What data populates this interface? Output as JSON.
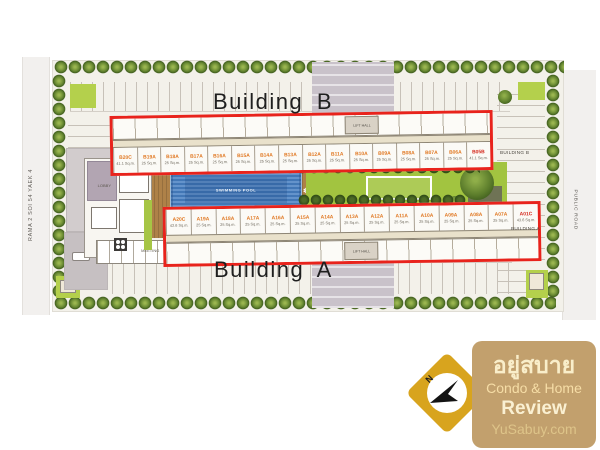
{
  "plan": {
    "title_building_b": "Building B",
    "title_building_a": "Building A",
    "side_label_building_b": "BUILDING B",
    "side_label_building_a": "BUILDING A",
    "road_left": "RAMA 2  SOI 54 YAEK 4",
    "road_right": "PUBLIC ROAD",
    "swimming_pool_label": "SWIMMING POOL",
    "lobby_label": "LOBBY",
    "meeting_label": "MEETING",
    "lift_hall_label": "LIFT HALL",
    "building_b_units": [
      {
        "id": "B20C",
        "area": "41.1 Sq.m."
      },
      {
        "id": "B19A",
        "area": "25 Sq.m."
      },
      {
        "id": "B18A",
        "area": "25 Sq.m."
      },
      {
        "id": "B17A",
        "area": "25 Sq.m."
      },
      {
        "id": "B16A",
        "area": "25 Sq.m."
      },
      {
        "id": "B15A",
        "area": "25 Sq.m."
      },
      {
        "id": "B14A",
        "area": "25 Sq.m."
      },
      {
        "id": "B13A",
        "area": "25 Sq.m."
      },
      {
        "id": "B12A",
        "area": "25 Sq.m."
      },
      {
        "id": "B11A",
        "area": "25 Sq.m."
      },
      {
        "id": "B10A",
        "area": "25 Sq.m."
      },
      {
        "id": "B09A",
        "area": "25 Sq.m."
      },
      {
        "id": "B08A",
        "area": "25 Sq.m."
      },
      {
        "id": "B07A",
        "area": "25 Sq.m."
      },
      {
        "id": "B06A",
        "area": "25 Sq.m."
      },
      {
        "id": "B05B",
        "area": "41.1 Sq.m.",
        "cls": "red"
      }
    ],
    "building_a_units": [
      {
        "id": "A20C",
        "area": "43.6 Sq.m."
      },
      {
        "id": "A19A",
        "area": "25 Sq.m."
      },
      {
        "id": "A18A",
        "area": "25 Sq.m."
      },
      {
        "id": "A17A",
        "area": "25 Sq.m."
      },
      {
        "id": "A16A",
        "area": "25 Sq.m."
      },
      {
        "id": "A15A",
        "area": "25 Sq.m."
      },
      {
        "id": "A14A",
        "area": "25 Sq.m."
      },
      {
        "id": "A13A",
        "area": "25 Sq.m."
      },
      {
        "id": "A12A",
        "area": "25 Sq.m."
      },
      {
        "id": "A11A",
        "area": "25 Sq.m."
      },
      {
        "id": "A10A",
        "area": "25 Sq.m."
      },
      {
        "id": "A09A",
        "area": "25 Sq.m."
      },
      {
        "id": "A08A",
        "area": "25 Sq.m."
      },
      {
        "id": "A07A",
        "area": "25 Sq.m."
      },
      {
        "id": "A01C",
        "area": "43.6 Sq.m.",
        "cls": "red"
      }
    ],
    "colors": {
      "building_outline_red": "#e8231c",
      "unit_label_orange": "#e0761f",
      "unit_label_red": "#d4281c",
      "pool_blue": "#4277b6",
      "lawn_green": "#a2c440",
      "tree_green": "#5d7e2c"
    }
  },
  "watermark": {
    "compass_n": "N",
    "brand_thai": "อยู่สบาย",
    "line1": "Condo & Home",
    "line2": "Review",
    "line3": "YuSabuy.com",
    "colors": {
      "diamond_gold": "#d8a41e",
      "panel_tan": "#c2a06d",
      "text_cream": "#f9eeca"
    }
  }
}
